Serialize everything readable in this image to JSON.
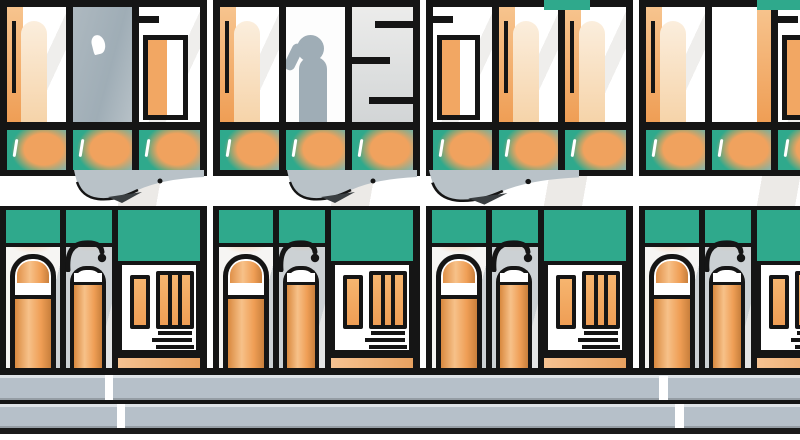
{
  "meta": {
    "subject": "Flat vector-style illustration of a repeating city building facade: tall black-framed windows (one with a person silhouette), teal and orange accent windows, white cornice band with gray bird silhouettes, ground-floor doorways with steps, orange parking meters with hooked poles, gray sidewalk and street"
  },
  "palette": {
    "black": "#151515",
    "white": "#ffffff",
    "offwhite": "#f4f3f1",
    "lightgray": "#dcdedf",
    "piergray": "#ccd1d4",
    "slategray": "#a9b5bd",
    "silhouette": "#9fadb6",
    "sidewalk": "#b6c0c9",
    "teal": "#2fa98c",
    "orange": "#f0a25e",
    "lightorange": "#f7c48e",
    "cream": "#f7e3c9",
    "birdgray": "#b9c2c8"
  },
  "scene": {
    "module_pitch_px": 213,
    "modules": [
      {
        "bays": [
          "curtain",
          "glass",
          "inner"
        ],
        "bird": "right",
        "roof_accent": false
      },
      {
        "bays": [
          "curtain",
          "person",
          "rails"
        ],
        "bird": "right",
        "roof_accent": false
      },
      {
        "bays": [
          "inner",
          "curtain",
          "curtain"
        ],
        "bird": "left",
        "roof_accent": true
      },
      {
        "bays": [
          "curtain",
          "white",
          "inner"
        ],
        "bird": null,
        "roof_accent": true
      }
    ],
    "parking_meters_per_module": 2,
    "doors_per_module": 1,
    "street": {
      "sidewalk_bands": 2,
      "curb_breaks": 4
    }
  }
}
